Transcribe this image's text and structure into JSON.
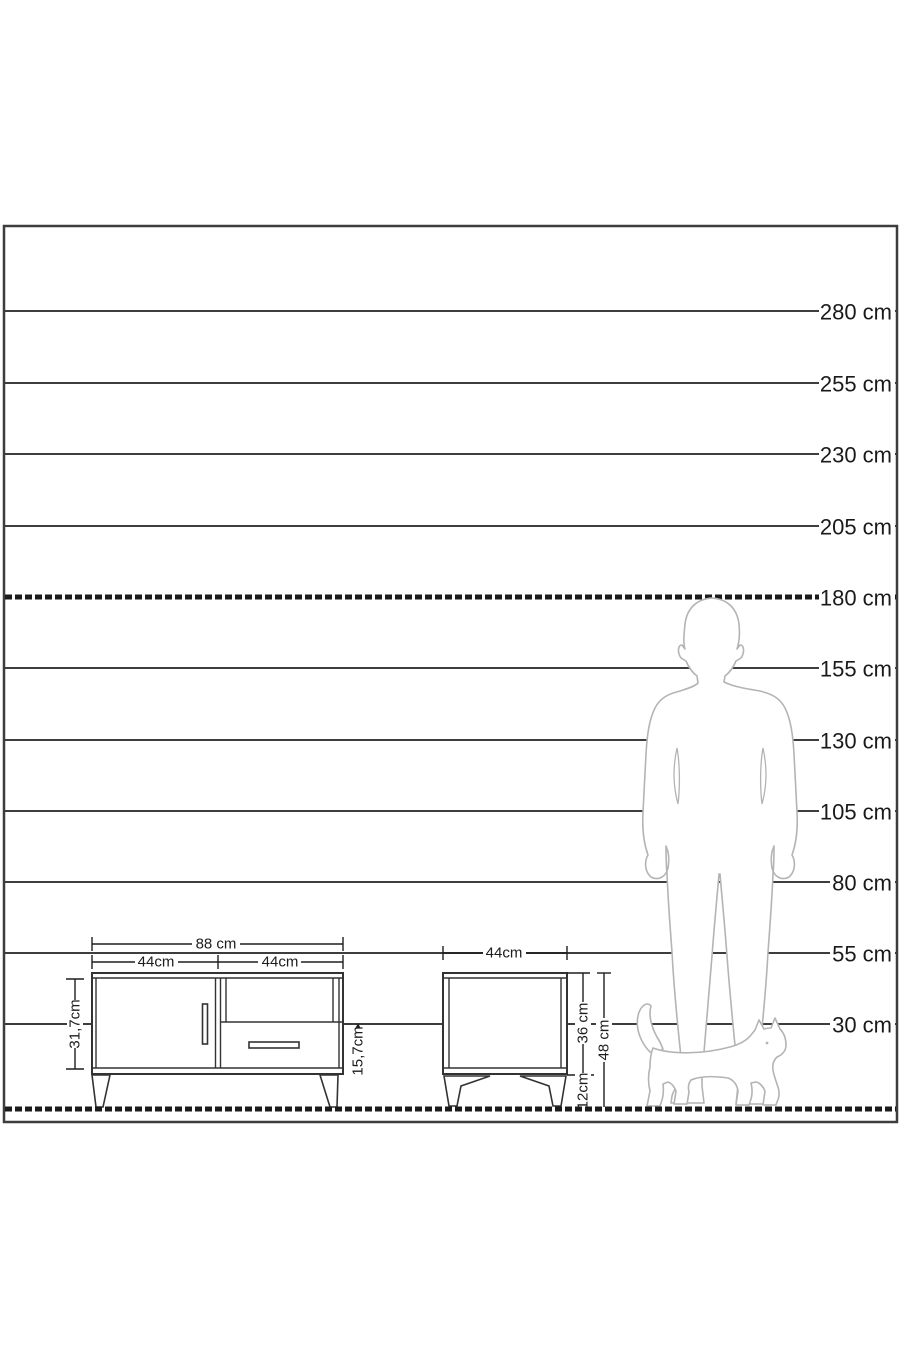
{
  "scale": {
    "labels": [
      "280 cm",
      "255 cm",
      "230 cm",
      "205 cm",
      "180 cm",
      "155 cm",
      "130 cm",
      "105 cm",
      "80 cm",
      "55 cm",
      "30 cm"
    ]
  },
  "tv_stand": {
    "width_label": "88 cm",
    "door_width_label": "44cm",
    "right_section_width_label": "44cm",
    "body_height_label": "31,7cm",
    "shelf_height_label": "15,7cm"
  },
  "nightstand": {
    "width_label": "44cm",
    "body_height_label": "36 cm",
    "leg_height_label": "12cm",
    "total_height_label": "48 cm"
  },
  "figures": {
    "man_icon": "man-silhouette",
    "cat_icon": "cat-silhouette"
  },
  "colors": {
    "frame_line": "#3d3d3d",
    "emphasis_line": "#1b1b1b",
    "furniture_line": "#333333",
    "dimension_line": "#1f1f1f",
    "silhouette_line": "#b4b4b4",
    "text": "#1a1a1a",
    "background": "#ffffff"
  }
}
